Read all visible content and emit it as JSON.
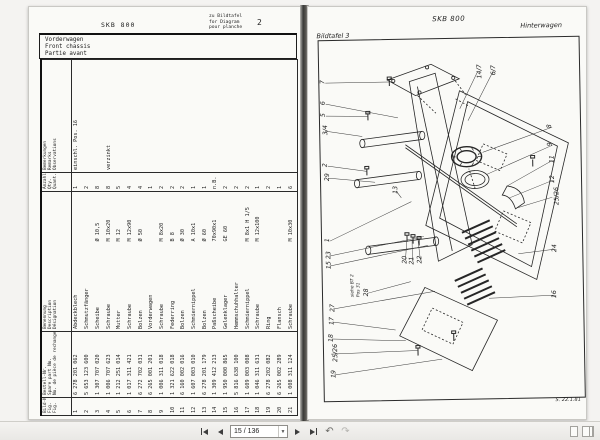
{
  "viewer": {
    "toolbar": {
      "page_indicator": "15 / 136",
      "icons": {
        "first_page": "first-page-icon",
        "previous_page": "previous-page-icon",
        "next_page": "next-page-icon",
        "last_page": "last-page-icon",
        "previous_view": "previous-view-icon",
        "next_view": "next-view-icon",
        "single_page": "single-page-icon",
        "facing_pages": "facing-pages-icon"
      }
    }
  },
  "left_page": {
    "doc_code": "SKB 800",
    "ref_note_lines": [
      "zu Bildtafel",
      "for Diagram",
      "pour planche"
    ],
    "ref_number": "2",
    "title_box_lines": [
      "Vorderwagen",
      "Front chassis",
      "Partie avant"
    ],
    "table": {
      "headers": {
        "fig": [
          "Bild-Nr.",
          "Fig.",
          "Fig."
        ],
        "part_no": [
          "Bestell-Nr.",
          "Spare part No.",
          "No. de pièce de rechange"
        ],
        "name": [
          "Benennung",
          "Description",
          "Désignation"
        ],
        "qty": [
          "Anzahl",
          "Qty.",
          "Quant."
        ],
        "remarks": [
          "Bemerkungen",
          "Remarks",
          "Observations"
        ]
      },
      "rows": [
        {
          "fig": "1",
          "part_no": "6 278 201 062",
          "name": "Abdeckblech",
          "dim": "",
          "qty": "1",
          "remark": "einschl. Pos. 16"
        },
        {
          "fig": "2",
          "part_no": "5 653 123 600",
          "name": "Schmutzfänger",
          "dim": "",
          "qty": "2",
          "remark": ""
        },
        {
          "fig": "3",
          "part_no": "1 307 707 020",
          "name": "Scheibe",
          "dim": "Ø 10,5",
          "qty": "8",
          "remark": ""
        },
        {
          "fig": "4",
          "part_no": "1 006 707 623",
          "name": "Schraube",
          "dim": "M 10x20",
          "qty": "8",
          "remark": "verzinkt"
        },
        {
          "fig": "5",
          "part_no": "1 212 251 014",
          "name": "Mutter",
          "dim": "M 12",
          "qty": "5",
          "remark": ""
        },
        {
          "fig": "6",
          "part_no": "1 017 311 421",
          "name": "Schraube",
          "dim": "M 12x90",
          "qty": "4",
          "remark": ""
        },
        {
          "fig": "7",
          "part_no": "6 272 702 031",
          "name": "Bolzen",
          "dim": "Ø 50",
          "qty": "4",
          "remark": ""
        },
        {
          "fig": "8",
          "part_no": "6 265 001 201",
          "name": "Vorderwagen",
          "dim": "",
          "qty": "1",
          "remark": ""
        },
        {
          "fig": "9",
          "part_no": "1 006 311 018",
          "name": "Schraube",
          "dim": "M 8x20",
          "qty": "2",
          "remark": ""
        },
        {
          "fig": "10",
          "part_no": "1 321 622 018",
          "name": "Federring",
          "dim": "B 8",
          "qty": "2",
          "remark": ""
        },
        {
          "fig": "11",
          "part_no": "6 160 002 016",
          "name": "Bolzen",
          "dim": "Ø 30",
          "qty": "2",
          "remark": ""
        },
        {
          "fig": "12",
          "part_no": "1 607 003 010",
          "name": "Schmiernippel",
          "dim": "A 10x1",
          "qty": "1",
          "remark": ""
        },
        {
          "fig": "13",
          "part_no": "6 278 201 179",
          "name": "Bolzen",
          "dim": "Ø 60",
          "qty": "1",
          "remark": ""
        },
        {
          "fig": "14",
          "part_no": "1 309 412 213",
          "name": "Paßscheibe",
          "dim": "70x90x1",
          "qty": "n.B.",
          "remark": ""
        },
        {
          "fig": "15",
          "part_no": "1 950 000 865",
          "name": "Gelenklager",
          "dim": "GE 60",
          "qty": "2",
          "remark": ""
        },
        {
          "fig": "16",
          "part_no": "5 816 638 100",
          "name": "Hemmschuhhalter",
          "dim": "",
          "qty": "2",
          "remark": ""
        },
        {
          "fig": "17",
          "part_no": "1 609 003 008",
          "name": "Schmiernippel",
          "dim": "M 8x1 H 1/5",
          "qty": "2",
          "remark": ""
        },
        {
          "fig": "18",
          "part_no": "1 046 311 631",
          "name": "Schraube",
          "dim": "M 12x100",
          "qty": "1",
          "remark": ""
        },
        {
          "fig": "19",
          "part_no": "6 278 202 082",
          "name": "Ring",
          "dim": "",
          "qty": "2",
          "remark": ""
        },
        {
          "fig": "20",
          "part_no": "6 265 002 289",
          "name": "Flansch",
          "dim": "",
          "qty": "1",
          "remark": ""
        },
        {
          "fig": "21",
          "part_no": "1 008 311 124",
          "name": "Schraube",
          "dim": "M 10x30",
          "qty": "6",
          "remark": ""
        }
      ]
    }
  },
  "right_page": {
    "doc_code": "SKB 800",
    "plate_label": "Bildtafel 3",
    "section_label": "Hinterwagen",
    "date_note": "S. 22.1.81",
    "callouts": [
      {
        "label": "7",
        "x": 12,
        "y": 48,
        "tx": 80,
        "ty": 52
      },
      {
        "label": "6",
        "x": 12,
        "y": 69,
        "tx": 88,
        "ty": 88
      },
      {
        "label": "5",
        "x": 12,
        "y": 81,
        "tx": 58,
        "ty": 86
      },
      {
        "label": "3/4",
        "x": 11,
        "y": 96,
        "tx": 52,
        "ty": 106
      },
      {
        "label": "2",
        "x": 13,
        "y": 131,
        "tx": 56,
        "ty": 141
      },
      {
        "label": "29",
        "x": 13,
        "y": 143,
        "tx": 64,
        "ty": 152
      },
      {
        "label": "1",
        "x": 14,
        "y": 206,
        "tx": 100,
        "ty": 172
      },
      {
        "label": "23",
        "x": 13,
        "y": 221,
        "tx": 112,
        "ty": 207
      },
      {
        "label": "15",
        "x": 13,
        "y": 231,
        "tx": 116,
        "ty": 216
      },
      {
        "label": "28",
        "x": 50,
        "y": 259,
        "tx": 98,
        "ty": 252
      },
      {
        "label": "27",
        "x": 16,
        "y": 274,
        "tx": 122,
        "ty": 262
      },
      {
        "label": "17",
        "x": 15,
        "y": 287,
        "tx": 82,
        "ty": 300
      },
      {
        "label": "18",
        "x": 14,
        "y": 304,
        "tx": 92,
        "ty": 311
      },
      {
        "label": "25/26",
        "x": 13,
        "y": 319,
        "tx": 104,
        "ty": 321
      },
      {
        "label": "19",
        "x": 16,
        "y": 340,
        "tx": 128,
        "ty": 330
      },
      {
        "label": "14/7",
        "x": 164,
        "y": 40,
        "tx": 150,
        "ty": 80
      },
      {
        "label": "6/7",
        "x": 180,
        "y": 39,
        "tx": 158,
        "ty": 92
      },
      {
        "label": "8",
        "x": 238,
        "y": 96,
        "tx": 172,
        "ty": 124
      },
      {
        "label": "9",
        "x": 238,
        "y": 114,
        "tx": 176,
        "ty": 146
      },
      {
        "label": "11",
        "x": 238,
        "y": 129,
        "tx": 196,
        "ty": 158
      },
      {
        "label": "12",
        "x": 238,
        "y": 149,
        "tx": 198,
        "ty": 170
      },
      {
        "label": "25/26",
        "x": 237,
        "y": 166,
        "tx": 206,
        "ty": 180
      },
      {
        "label": "24",
        "x": 239,
        "y": 218,
        "tx": 206,
        "ty": 226
      },
      {
        "label": "16",
        "x": 238,
        "y": 264,
        "tx": 176,
        "ty": 270
      },
      {
        "label": "20",
        "x": 89,
        "y": 227,
        "tx": 95,
        "ty": 208
      },
      {
        "label": "21",
        "x": 96,
        "y": 228,
        "tx": 100,
        "ty": 210
      },
      {
        "label": "22",
        "x": 104,
        "y": 227,
        "tx": 106,
        "ty": 211
      },
      {
        "label": "13",
        "x": 81,
        "y": 157,
        "tx": 90,
        "ty": 168
      },
      {
        "label": "siehe BT 2\nPos 31",
        "x": 32,
        "y": 249,
        "note": true
      }
    ]
  }
}
